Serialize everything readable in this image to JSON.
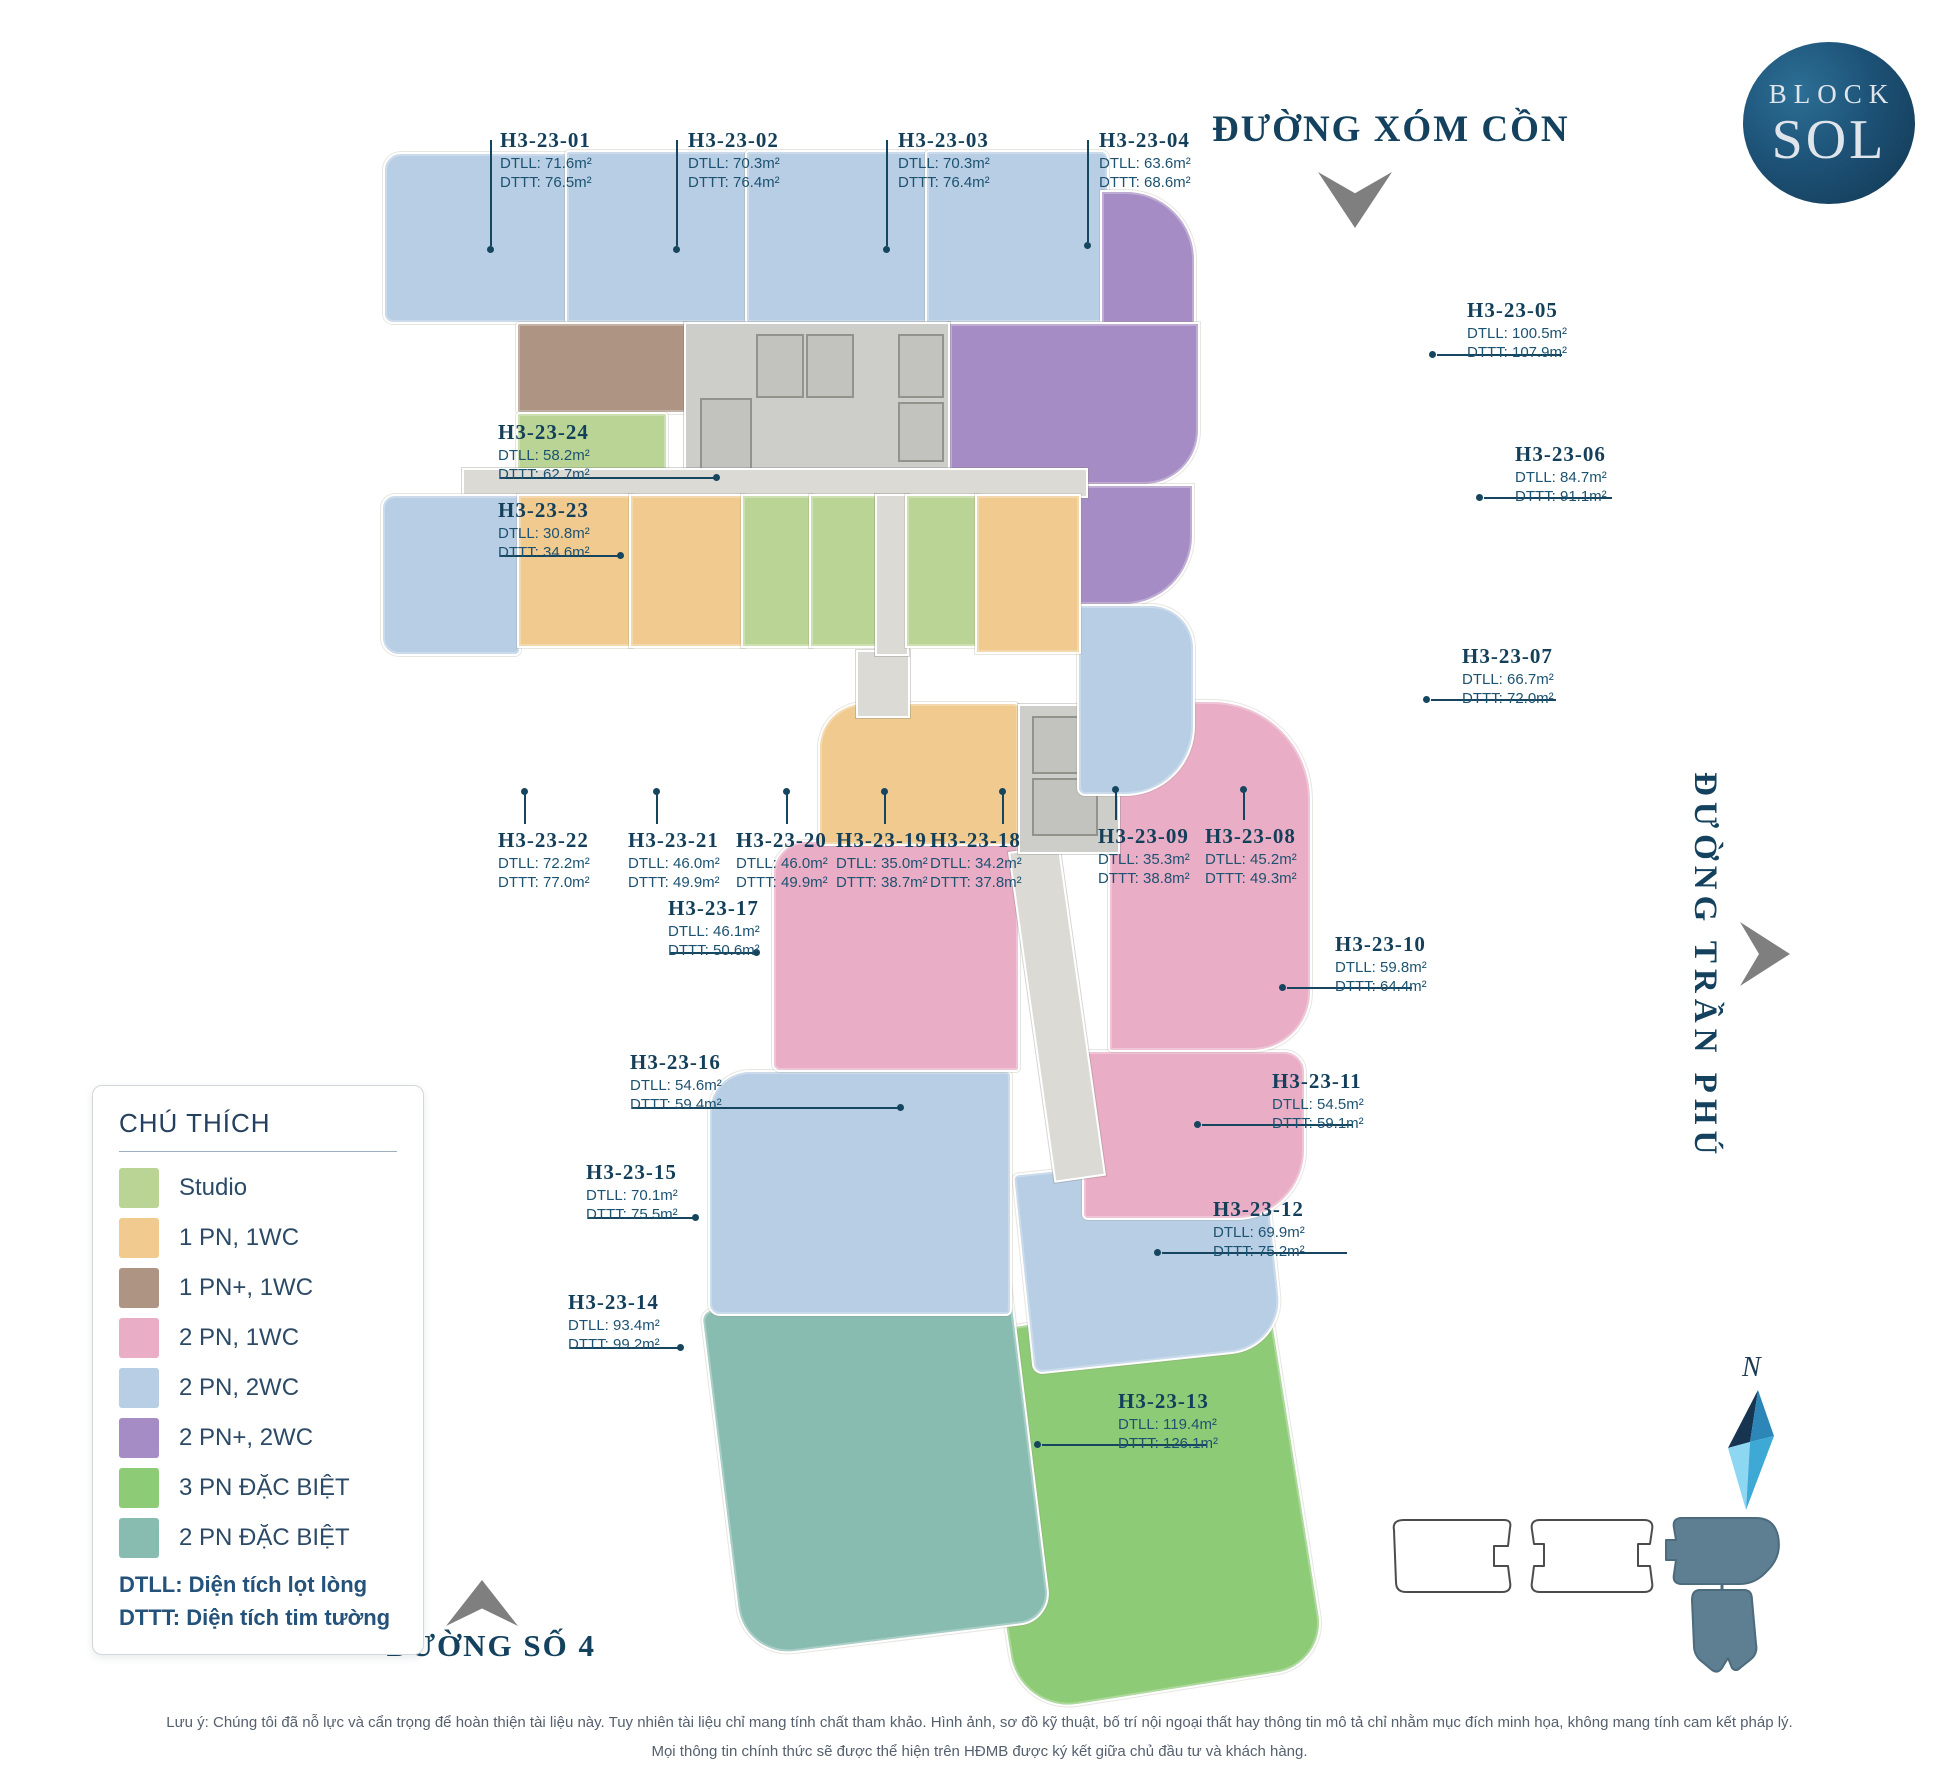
{
  "logo": {
    "line1": "BLOCK",
    "line2": "SOL"
  },
  "streets": {
    "top": "ĐƯỜNG XÓM CỒN",
    "right": "ĐƯỜNG TRẦN PHÚ",
    "bottom": "ĐƯỜNG SỐ 4"
  },
  "compass": {
    "north_label": "N"
  },
  "colors": {
    "studio": "#b9d494",
    "pn1": "#f0ca8e",
    "pn1plus": "#ae9483",
    "pn2_1wc": "#e9aec6",
    "pn2_2wc": "#b7cee4",
    "pn2plus": "#a58cc4",
    "pn3db": "#8ecb77",
    "pn2db": "#88bcb1",
    "core": "#cdcdc9",
    "corridor": "#dbdad5",
    "minimap_fill": "#5d7f91",
    "accent_navy": "#16455f"
  },
  "legend": {
    "title": "CHÚ THÍCH",
    "items": [
      {
        "label": "Studio"
      },
      {
        "label": "1 PN, 1WC"
      },
      {
        "label": "1 PN+, 1WC"
      },
      {
        "label": "2 PN, 1WC"
      },
      {
        "label": "2 PN, 2WC"
      },
      {
        "label": "2 PN+, 2WC"
      },
      {
        "label": "3 PN ĐẶC BIỆT"
      },
      {
        "label": "2 PN ĐẶC BIỆT"
      }
    ],
    "notes": [
      "DTLL: Diện tích lọt lòng",
      "DTTT: Diện tích tim tường"
    ]
  },
  "units": [
    {
      "id": "H3-23-01",
      "dtll": "DTLL: 71.6m²",
      "dttt": "DTTT: 76.5m²"
    },
    {
      "id": "H3-23-02",
      "dtll": "DTLL: 70.3m²",
      "dttt": "DTTT: 76.4m²"
    },
    {
      "id": "H3-23-03",
      "dtll": "DTLL: 70.3m²",
      "dttt": "DTTT: 76.4m²"
    },
    {
      "id": "H3-23-04",
      "dtll": "DTLL: 63.6m²",
      "dttt": "DTTT: 68.6m²"
    },
    {
      "id": "H3-23-05",
      "dtll": "DTLL: 100.5m²",
      "dttt": "DTTT: 107.9m²"
    },
    {
      "id": "H3-23-06",
      "dtll": "DTLL: 84.7m²",
      "dttt": "DTTT: 91.1m²"
    },
    {
      "id": "H3-23-07",
      "dtll": "DTLL: 66.7m²",
      "dttt": "DTTT: 72.0m²"
    },
    {
      "id": "H3-23-08",
      "dtll": "DTLL: 45.2m²",
      "dttt": "DTTT: 49.3m²"
    },
    {
      "id": "H3-23-09",
      "dtll": "DTLL: 35.3m²",
      "dttt": "DTTT: 38.8m²"
    },
    {
      "id": "H3-23-10",
      "dtll": "DTLL: 59.8m²",
      "dttt": "DTTT: 64.4m²"
    },
    {
      "id": "H3-23-11",
      "dtll": "DTLL: 54.5m²",
      "dttt": "DTTT: 59.1m²"
    },
    {
      "id": "H3-23-12",
      "dtll": "DTLL: 69.9m²",
      "dttt": "DTTT: 75.2m²"
    },
    {
      "id": "H3-23-13",
      "dtll": "DTLL: 119.4m²",
      "dttt": "DTTT: 126.1m²"
    },
    {
      "id": "H3-23-14",
      "dtll": "DTLL: 93.4m²",
      "dttt": "DTTT: 99.2m²"
    },
    {
      "id": "H3-23-15",
      "dtll": "DTLL: 70.1m²",
      "dttt": "DTTT: 75.5m²"
    },
    {
      "id": "H3-23-16",
      "dtll": "DTLL: 54.6m²",
      "dttt": "DTTT: 59.4m²"
    },
    {
      "id": "H3-23-17",
      "dtll": "DTLL: 46.1m²",
      "dttt": "DTTT: 50.6m²"
    },
    {
      "id": "H3-23-18",
      "dtll": "DTLL: 34.2m²",
      "dttt": "DTTT: 37.8m²"
    },
    {
      "id": "H3-23-19",
      "dtll": "DTLL: 35.0m²",
      "dttt": "DTTT: 38.7m²"
    },
    {
      "id": "H3-23-20",
      "dtll": "DTLL: 46.0m²",
      "dttt": "DTTT: 49.9m²"
    },
    {
      "id": "H3-23-21",
      "dtll": "DTLL: 46.0m²",
      "dttt": "DTTT: 49.9m²"
    },
    {
      "id": "H3-23-22",
      "dtll": "DTLL: 72.2m²",
      "dttt": "DTTT: 77.0m²"
    },
    {
      "id": "H3-23-23",
      "dtll": "DTLL: 30.8m²",
      "dttt": "DTTT: 34.6m²"
    },
    {
      "id": "H3-23-24",
      "dtll": "DTLL: 58.2m²",
      "dttt": "DTTT: 62.7m²"
    }
  ],
  "disclaimer": {
    "line1": "Lưu ý: Chúng tôi đã nỗ lực và cẩn trọng để hoàn thiện tài liệu này. Tuy nhiên tài liệu chỉ mang tính chất tham khảo. Hình ảnh, sơ đồ kỹ thuật, bố trí nội ngoại thất hay thông tin mô tả chỉ nhằm mục đích minh họa, không mang tính cam kết pháp lý.",
    "line2": "Mọi thông tin chính thức sẽ được thể hiện trên HĐMB được ký kết giữa chủ đầu tư và khách hàng."
  }
}
